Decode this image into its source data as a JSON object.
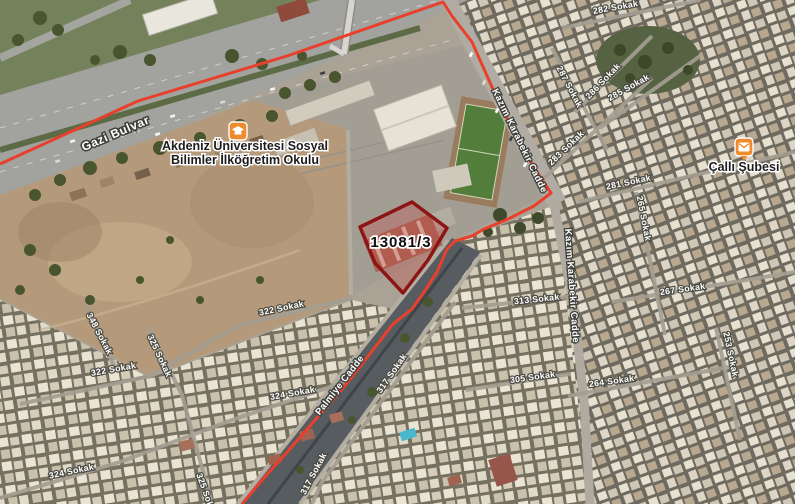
{
  "map": {
    "parcel": {
      "label": "13081/3"
    },
    "pois": {
      "school": {
        "name": "Akdeniz Üniversitesi Sosyal Bilimler İlköğretim Okulu",
        "lines": [
          "Akdeniz Üniversitesi Sosyal",
          "Bilimler İlköğretim Okulu"
        ],
        "icon": "school-icon"
      },
      "post_office": {
        "name": "Çallı Şubesi",
        "icon": "post-office-icon"
      }
    },
    "road_labels": [
      {
        "text": "Gazi Bulvar",
        "x": 117,
        "y": 137,
        "rot": -23,
        "cls": "lbl-road-lg",
        "name": "road-label-gazi-bulvar"
      },
      {
        "text": "Kazım Karabekir Cadde",
        "x": 517,
        "y": 142,
        "rot": 64,
        "cls": "",
        "name": "road-label-kazim-karabekir-1"
      },
      {
        "text": "Kazım Karabekir Cadde",
        "x": 569,
        "y": 286,
        "rot": 86,
        "cls": "",
        "name": "road-label-kazim-karabekir-2"
      },
      {
        "text": "Palmiye Cadde",
        "x": 342,
        "y": 387,
        "rot": -52,
        "cls": "",
        "name": "road-label-palmiye-cadde"
      }
    ],
    "street_labels": [
      {
        "text": "282 Sokak",
        "x": 616,
        "y": 10,
        "rot": -10
      },
      {
        "text": "287 Sokak",
        "x": 567,
        "y": 88,
        "rot": 62
      },
      {
        "text": "286 Sokak",
        "x": 605,
        "y": 83,
        "rot": -46
      },
      {
        "text": "285 Sokak",
        "x": 630,
        "y": 90,
        "rot": -29
      },
      {
        "text": "283 Sokak",
        "x": 568,
        "y": 150,
        "rot": -44
      },
      {
        "text": "281 Sokak",
        "x": 629,
        "y": 185,
        "rot": -12
      },
      {
        "text": "265 Sokak",
        "x": 641,
        "y": 219,
        "rot": 79
      },
      {
        "text": "267 Sokak",
        "x": 683,
        "y": 292,
        "rot": -8
      },
      {
        "text": "253 Sokak",
        "x": 728,
        "y": 355,
        "rot": 78
      },
      {
        "text": "264 Sokak",
        "x": 612,
        "y": 384,
        "rot": -8
      },
      {
        "text": "313 Sokak",
        "x": 537,
        "y": 302,
        "rot": -6
      },
      {
        "text": "305 Sokak",
        "x": 533,
        "y": 380,
        "rot": -8
      },
      {
        "text": "322 Sokak",
        "x": 282,
        "y": 311,
        "rot": -12
      },
      {
        "text": "322 Sokak",
        "x": 114,
        "y": 372,
        "rot": -10
      },
      {
        "text": "348 Sokak",
        "x": 97,
        "y": 335,
        "rot": 62
      },
      {
        "text": "325 Sokak",
        "x": 157,
        "y": 357,
        "rot": 65
      },
      {
        "text": "325 Sokak",
        "x": 204,
        "y": 496,
        "rot": 70
      },
      {
        "text": "324 Sokak",
        "x": 293,
        "y": 396,
        "rot": -10
      },
      {
        "text": "324 Sokak",
        "x": 72,
        "y": 474,
        "rot": -12
      },
      {
        "text": "317 Sokak",
        "x": 394,
        "y": 375,
        "rot": -55
      },
      {
        "text": "317 Sokak",
        "x": 316,
        "y": 475,
        "rot": -62
      }
    ],
    "colors": {
      "boundary_red": "#e8402c",
      "parcel_stroke": "#8e1515",
      "parcel_fill": "rgba(205,60,60,0.28)",
      "poi_icon_orange": "#ef8b2e",
      "road_label_text": "#ffffff",
      "poi_label_text": "#1c1c1c"
    }
  }
}
